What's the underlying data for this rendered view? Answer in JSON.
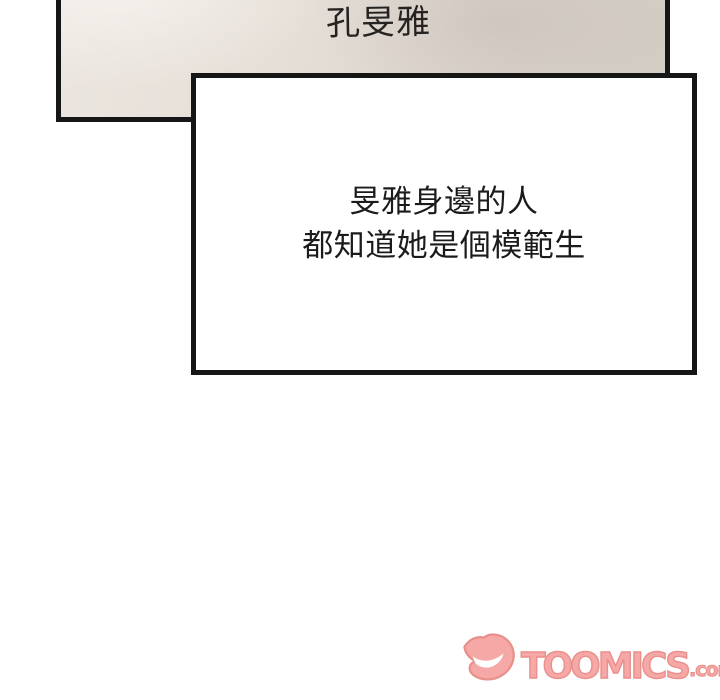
{
  "colors": {
    "page-bg": "#ffffff",
    "ink": "#161616",
    "panel-fill": "#e2dbd4",
    "speech-fill": "#ffffff",
    "speech-text": "#1b1b1b",
    "watermark-fill": "#f5a8a5",
    "watermark-outline": "#e98f8c"
  },
  "name_panel": {
    "text": "孔旻雅"
  },
  "speech_box": {
    "lines": [
      "旻雅身邊的人",
      "都知道她是個模範生"
    ]
  },
  "watermark": {
    "brand": "TOOMICS",
    "suffix": ".com",
    "logo": "toomics-smile-logo"
  }
}
